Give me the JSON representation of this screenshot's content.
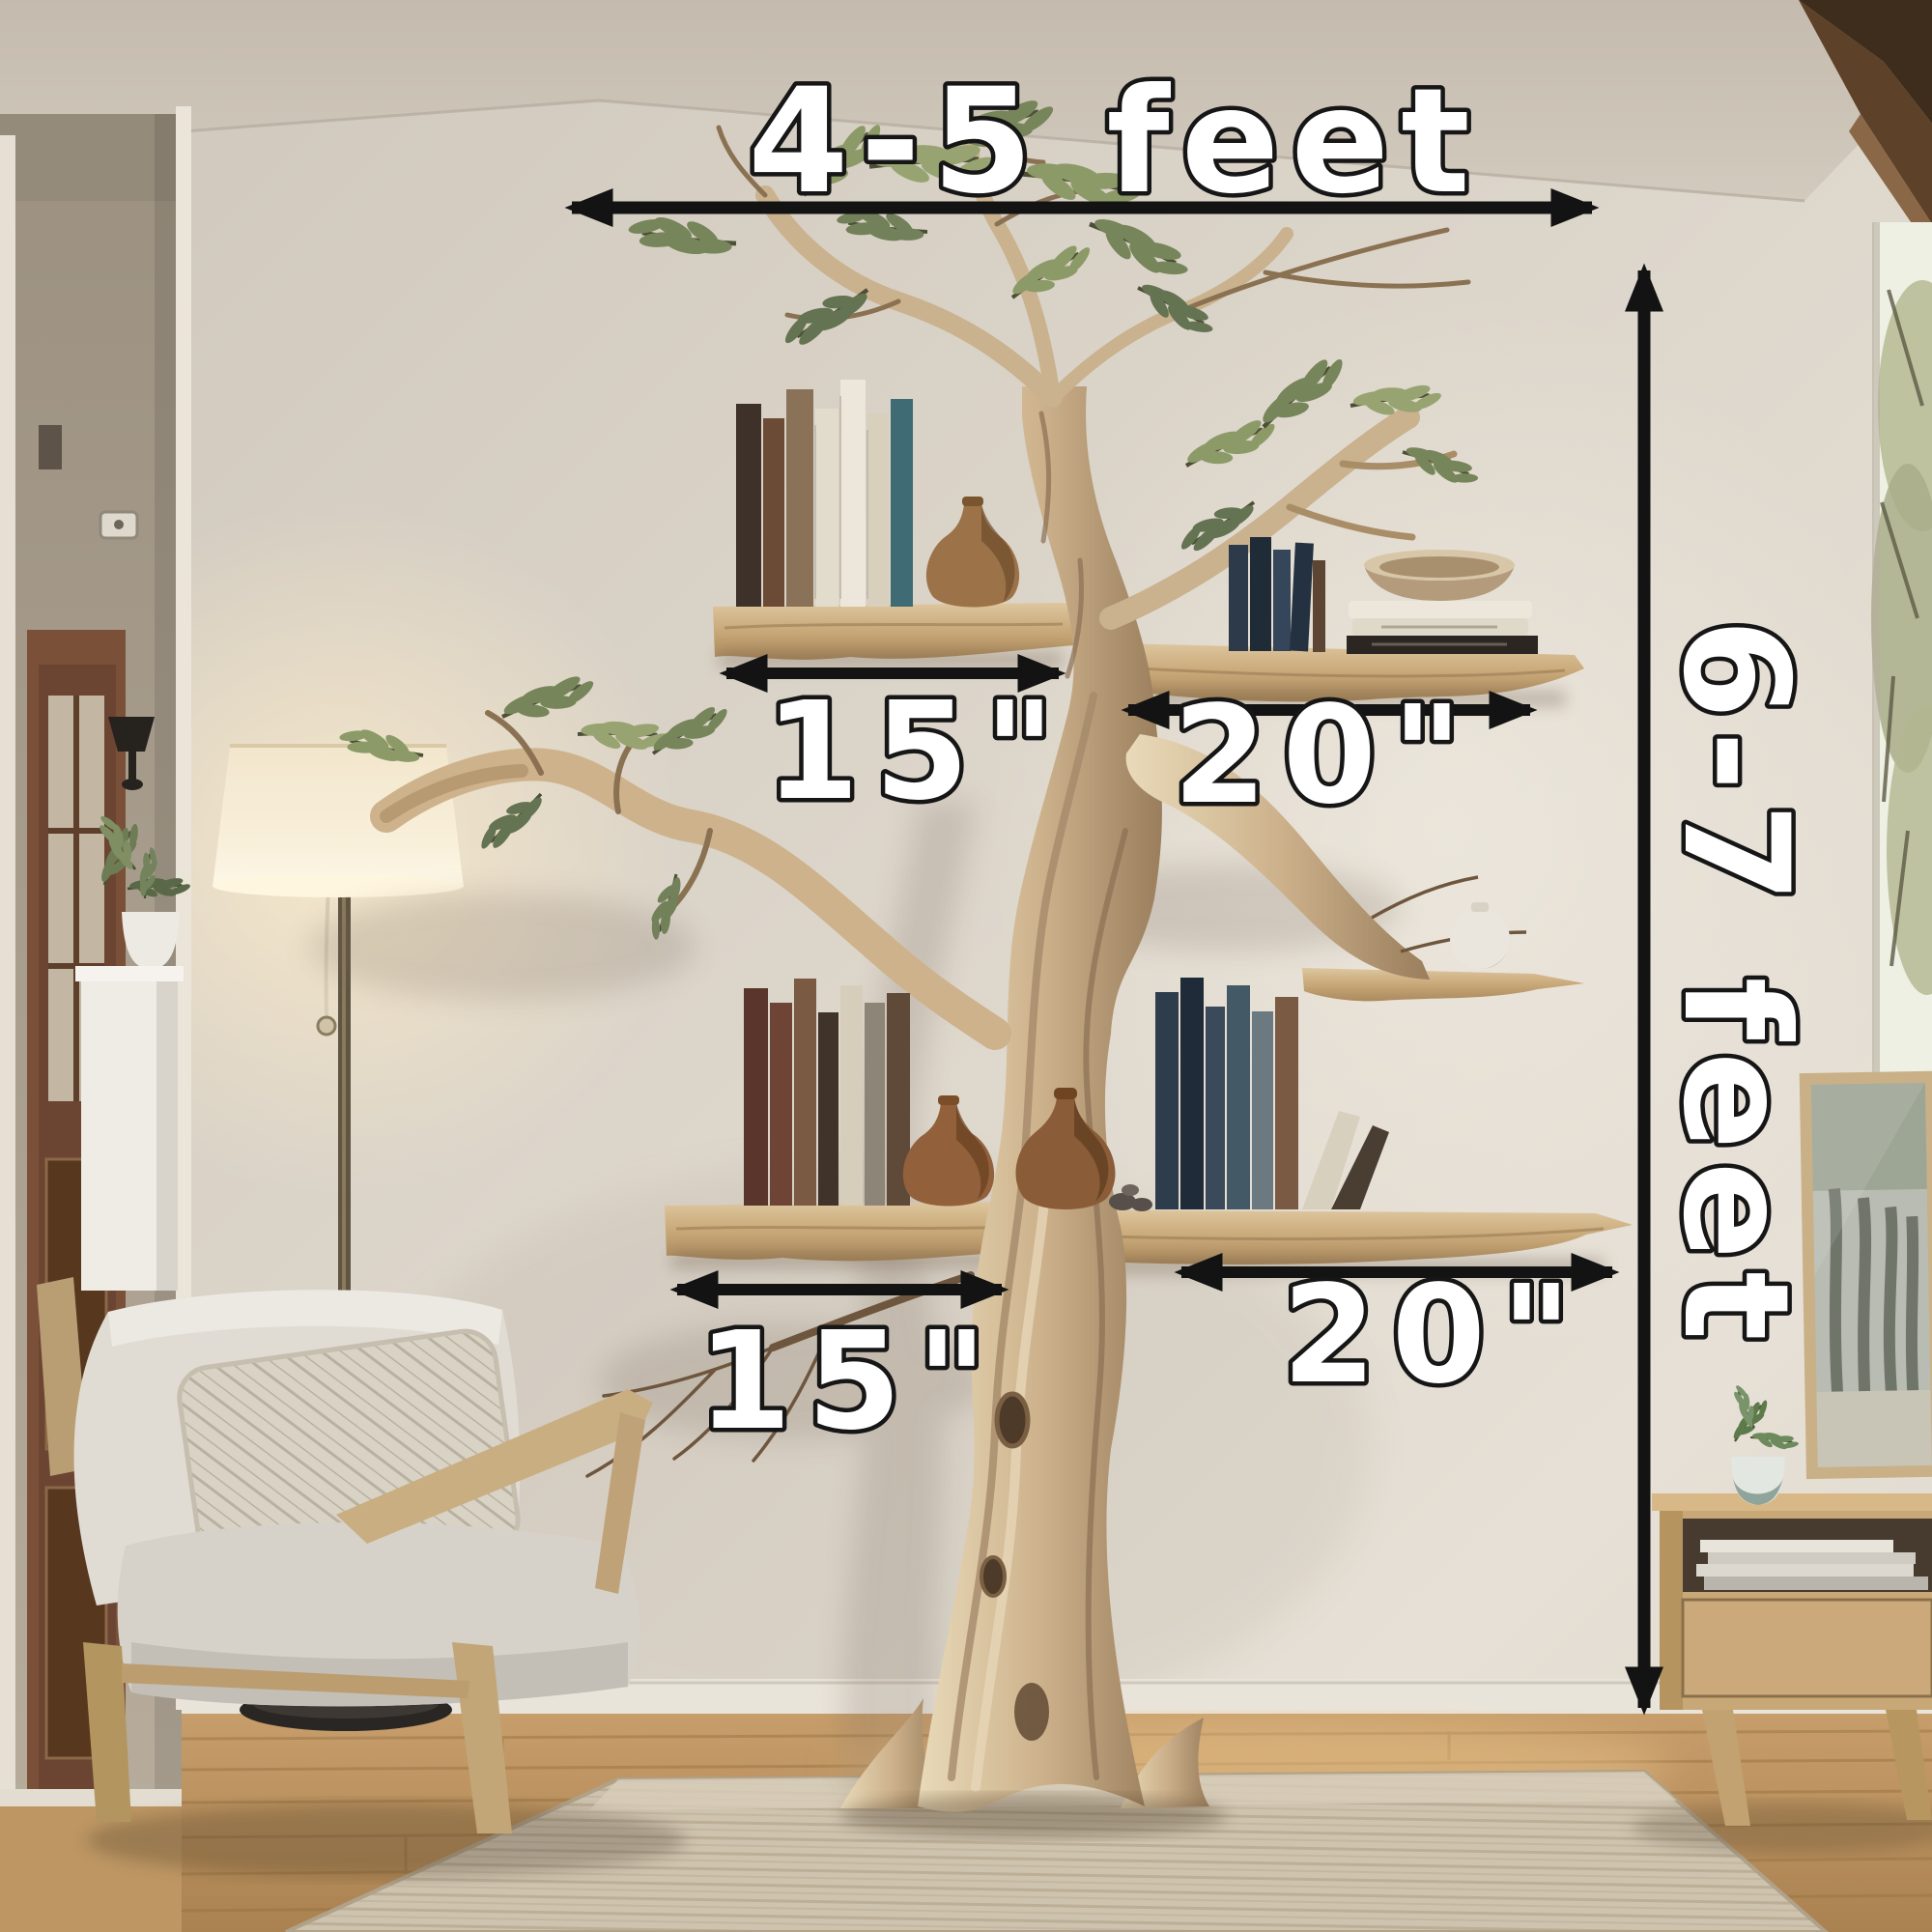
{
  "annotations": {
    "overall_width": {
      "label": "4-5 feet"
    },
    "overall_height": {
      "label": "6-7 feet"
    },
    "upper_left_shelf": {
      "label": "15\""
    },
    "upper_right_shelf": {
      "label": "20\""
    },
    "lower_left_shelf": {
      "label": "15\""
    },
    "lower_right_shelf": {
      "label": "20\""
    },
    "arrow_color": "#131313",
    "label_text_color": "#ffffff",
    "label_outline_color": "#161616"
  },
  "palette": {
    "wall": "#d9d2c8",
    "ceiling": "#cbc3b7",
    "driftwood": "#cfb692",
    "shelf_wood": "#d3b588",
    "floor_wood": "#c09059",
    "rug": "#cec3af",
    "armchair_fabric": "#d8d4cb",
    "lamp_shade": "#f7eed9",
    "foliage_green": "#7c8a5c",
    "beam_wood": "#4a351f",
    "door_wood": "#6b4531"
  }
}
